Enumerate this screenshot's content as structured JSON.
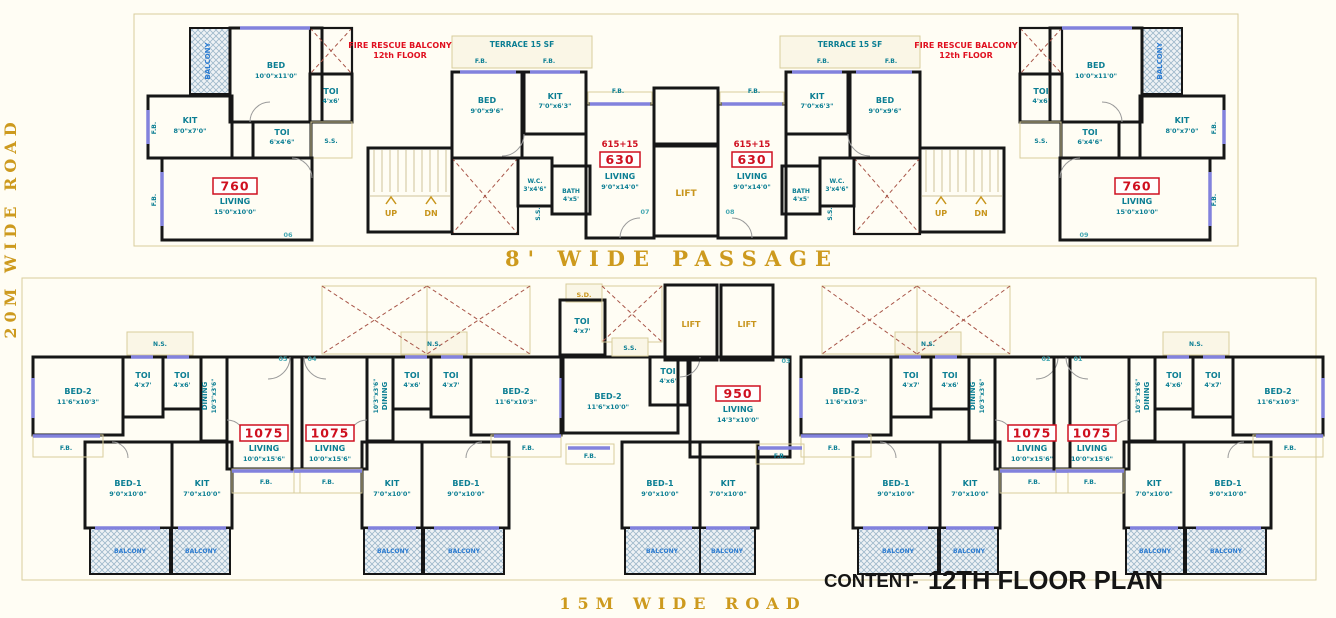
{
  "title_block": {
    "prefix": "CONTENT-",
    "text": "12TH FLOOR PLAN"
  },
  "roads": {
    "left": "20M WIDE ROAD",
    "bottom": "15M WIDE ROAD",
    "passage": "8' WIDE PASSAGE"
  },
  "notes": {
    "fire_rescue_1": "FIRE RESCUE BALCONY",
    "fire_rescue_2": "12th FLOOR",
    "terrace": "TERRACE 15 SF"
  },
  "abbr": {
    "fb": "F.B.",
    "ss": "S.S.",
    "sd": "S.D.",
    "ns": "N.S.",
    "up": "UP",
    "dn": "DN",
    "lift": "LIFT",
    "balcony": "BALCONY"
  },
  "units": {
    "u760": {
      "badge": "760",
      "living": "LIVING",
      "living_dim": "15'0\"x10'0\"",
      "bed": "BED",
      "bed_dim": "10'0\"x11'0\"",
      "kit": "KIT",
      "kit_dim": "8'0\"x7'0\"",
      "toi_a": "TOI",
      "toi_a_dim": "4'x6'",
      "toi_b": "TOI",
      "toi_b_dim": "6'x4'6\""
    },
    "u630": {
      "pre": "615+15",
      "badge": "630",
      "living": "LIVING",
      "living_dim": "9'0\"x14'0\"",
      "bed": "BED",
      "bed_dim": "9'0\"x9'6\"",
      "kit": "KIT",
      "kit_dim": "7'0\"x6'3\"",
      "wc": "W.C.",
      "wc_dim": "3'x4'6\"",
      "bath": "BATH",
      "bath_dim": "4'x5'"
    },
    "u1075": {
      "badge": "1075",
      "living": "LIVING",
      "living_dim": "10'0\"x15'6\"",
      "bed2": "BED-2",
      "bed2_dim": "11'6\"x10'3\"",
      "bed1": "BED-1",
      "bed1_dim": "9'0\"x10'0\"",
      "kit": "KIT",
      "kit_dim": "7'0\"x10'0\"",
      "toi_a": "TOI",
      "toi_a_dim": "4'x7'",
      "toi_b": "TOI",
      "toi_b_dim": "4'x6'",
      "dining": "DINING",
      "dining_dim": "10'3\"x3'6\""
    },
    "u950": {
      "badge": "950",
      "living": "LIVING",
      "living_dim": "14'3\"x10'0\"",
      "bed2": "BED-2",
      "bed2_dim": "11'6\"x10'0\"",
      "bed1": "BED-1",
      "bed1_dim": "9'0\"x10'0\"",
      "kit": "KIT",
      "kit_dim": "7'0\"x10'0\"",
      "toi": "TOI",
      "toi_dim": "4'x6'"
    }
  },
  "core": {
    "toi": "TOI",
    "toi_dim": "4'x7'"
  },
  "markers": {
    "m1": "01",
    "m2": "02",
    "m3": "03",
    "m4": "04",
    "m5": "05",
    "m6": "06",
    "m7": "07",
    "m8": "08",
    "m9": "09"
  },
  "colors": {
    "wall": "#161616",
    "room_text": "#0b7e93",
    "badge_red": "#cf1020",
    "accent_gold": "#cd9a1e",
    "window": "#8282dd",
    "void_x": "#a85548",
    "balcony_text": "#2d7dd2"
  }
}
